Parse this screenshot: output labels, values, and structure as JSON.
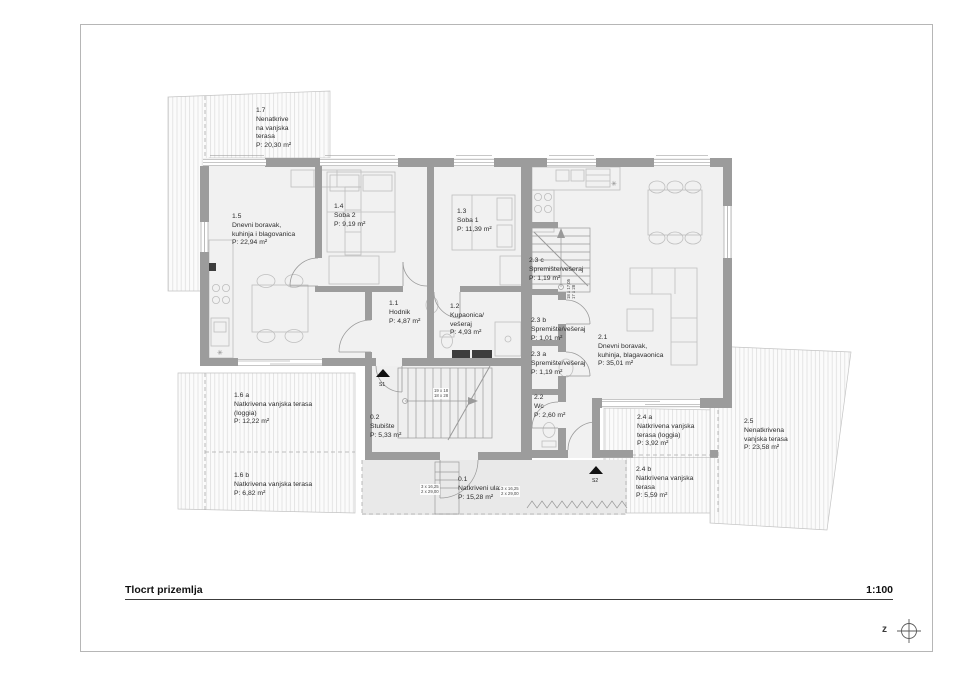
{
  "sheet": {
    "title": "Tlocrt prizemlja",
    "scale": "1:100",
    "compass_letter": "z"
  },
  "rooms": [
    {
      "num": "1.7",
      "l1": "Nenatkrive",
      "l2": "na vanjska",
      "l3": "terasa",
      "area": "P: 20,30 m²"
    },
    {
      "num": "1.5",
      "l1": "Dnevni boravak,",
      "l2": "kuhinja i blagovanica",
      "area": "P: 22,94 m²"
    },
    {
      "num": "1.4",
      "l1": "Soba 2",
      "area": "P: 9,19 m²"
    },
    {
      "num": "1.3",
      "l1": "Soba 1",
      "area": "P: 11,39 m²"
    },
    {
      "num": "1.1",
      "l1": "Hodnik",
      "area": "P: 4,87 m²"
    },
    {
      "num": "1.2",
      "l1": "Kupaonica/",
      "l2": "vešeraj",
      "area": "P: 4,93 m²"
    },
    {
      "num": "2.3 c",
      "l1": "Spremište/vešeraj",
      "area": "P: 1,19 m²"
    },
    {
      "num": "2.3 b",
      "l1": "Spremište/vešeraj",
      "area": "P: 1,01 m²"
    },
    {
      "num": "2.3 a",
      "l1": "Spremište/vešeraj",
      "area": "P: 1,19 m²"
    },
    {
      "num": "2.2",
      "l1": "Wc",
      "area": "P: 2,60 m²"
    },
    {
      "num": "2.1",
      "l1": "Dnevni boravak,",
      "l2": "kuhinja, blagavaonica",
      "area": "P: 35,01 m²"
    },
    {
      "num": "0.2",
      "l1": "Stubište",
      "area": "P: 5,33 m²"
    },
    {
      "num": "0.1",
      "l1": "Natkriveni ulaz",
      "area": "P: 15,28 m²"
    },
    {
      "num": "1.6 a",
      "l1": "Natkrivena vanjska terasa",
      "l2": "(loggia)",
      "area": "P: 12,22 m²"
    },
    {
      "num": "1.6 b",
      "l1": "Natkrivena vanjska terasa",
      "area": "P: 6,82 m²"
    },
    {
      "num": "2.4 a",
      "l1": "Natkrivena vanjska",
      "l2": "terasa (loggia)",
      "area": "P: 3,92 m²"
    },
    {
      "num": "2.4 b",
      "l1": "Natkrivena vanjska",
      "l2": "terasa",
      "area": "P: 5,59 m²"
    },
    {
      "num": "2.5",
      "l1": "Nenatkrivena",
      "l2": "vanjska terasa",
      "area": "P: 23,58 m²"
    }
  ],
  "markers": {
    "s1": "S1",
    "s2": "S2"
  },
  "annotations": {
    "stair_main_1": "19 x 18",
    "stair_main_2": "18 x 28",
    "stair_upper_1": "18 x 17,05",
    "stair_upper_2": "17 x 28",
    "steps_left_1": "3 x 16,25",
    "steps_left_2": "2 x 29,00",
    "steps_right_1": "3 x 16,25",
    "steps_right_2": "2 x 29,00"
  },
  "icons": {
    "light_fixture": "✳"
  },
  "colors": {
    "wall": "#9c9c9c",
    "floor": "#f1f1f1",
    "hatch_line": "#dcdcdc",
    "outline": "#c4c4c4",
    "text": "#2d2d2d"
  }
}
